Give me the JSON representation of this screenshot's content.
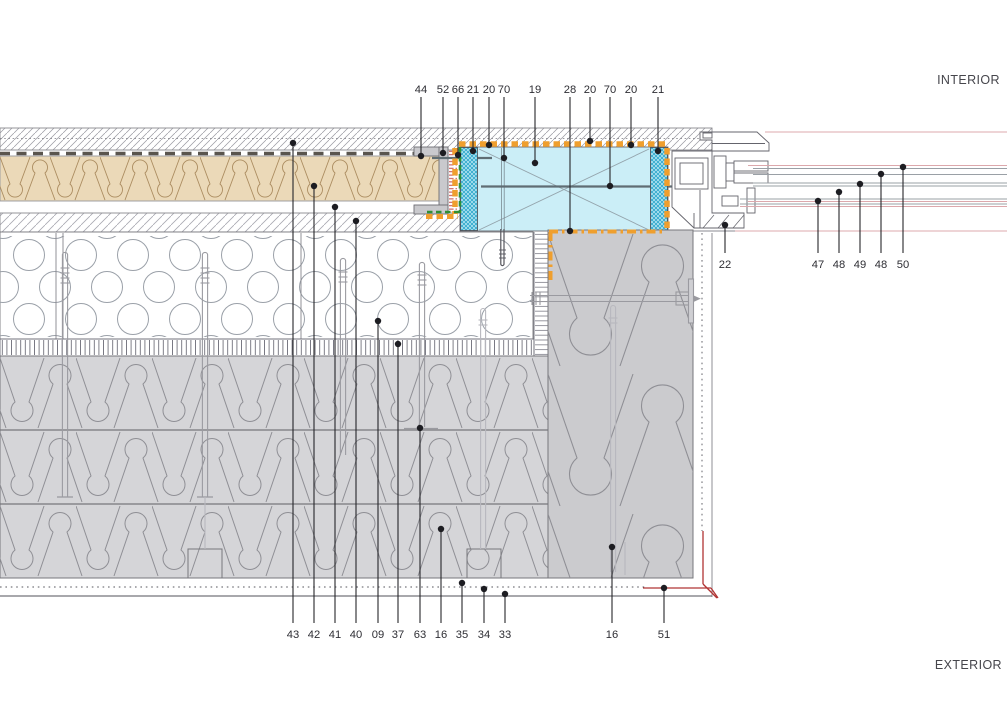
{
  "drawing": {
    "region_labels": {
      "interior": "INTERIOR",
      "exterior": "EXTERIOR"
    },
    "callouts": {
      "top": [
        {
          "label": "44",
          "x": 421,
          "dot_y": 156
        },
        {
          "label": "52",
          "x": 443,
          "dot_y": 153
        },
        {
          "label": "66",
          "x": 458,
          "dot_y": 155
        },
        {
          "label": "21",
          "x": 473,
          "dot_y": 151
        },
        {
          "label": "20",
          "x": 489,
          "dot_y": 145
        },
        {
          "label": "70",
          "x": 504,
          "dot_y": 158
        },
        {
          "label": "19",
          "x": 535,
          "dot_y": 163
        },
        {
          "label": "28",
          "x": 570,
          "dot_y": 231
        },
        {
          "label": "20",
          "x": 590,
          "dot_y": 141
        },
        {
          "label": "70",
          "x": 610,
          "dot_y": 186
        },
        {
          "label": "20",
          "x": 631,
          "dot_y": 145
        },
        {
          "label": "21",
          "x": 658,
          "dot_y": 151
        }
      ],
      "right": [
        {
          "label": "22",
          "x": 725,
          "dot_y": 225
        },
        {
          "label": "47",
          "x": 818,
          "dot_y": 201
        },
        {
          "label": "48",
          "x": 839,
          "dot_y": 192
        },
        {
          "label": "49",
          "x": 860,
          "dot_y": 184
        },
        {
          "label": "48",
          "x": 881,
          "dot_y": 174
        },
        {
          "label": "50",
          "x": 903,
          "dot_y": 167
        }
      ],
      "bottom": [
        {
          "label": "43",
          "x": 293,
          "dot_y": 143
        },
        {
          "label": "42",
          "x": 314,
          "dot_y": 186
        },
        {
          "label": "41",
          "x": 335,
          "dot_y": 207
        },
        {
          "label": "40",
          "x": 356,
          "dot_y": 221
        },
        {
          "label": "09",
          "x": 378,
          "dot_y": 321
        },
        {
          "label": "37",
          "x": 398,
          "dot_y": 344
        },
        {
          "label": "63",
          "x": 420,
          "dot_y": 428
        },
        {
          "label": "16",
          "x": 441,
          "dot_y": 529
        },
        {
          "label": "35",
          "x": 462,
          "dot_y": 583
        },
        {
          "label": "34",
          "x": 484,
          "dot_y": 589
        },
        {
          "label": "33",
          "x": 505,
          "dot_y": 594
        },
        {
          "label": "16",
          "x": 612,
          "dot_y": 547
        },
        {
          "label": "51",
          "x": 664,
          "dot_y": 588
        }
      ]
    },
    "colors": {
      "insulation_tan": "#ebd9b8",
      "window_cyan": "#cbeef7",
      "teal_hatch": "#1c9fc6",
      "seal_orange": "#ef9f2e",
      "seal_green": "#2f8f35",
      "membrane_red": "#c24a4a",
      "insulation_gray": "#d5d5d8",
      "block_gray": "#cbcbce",
      "boundary_red": "#b13434"
    }
  }
}
